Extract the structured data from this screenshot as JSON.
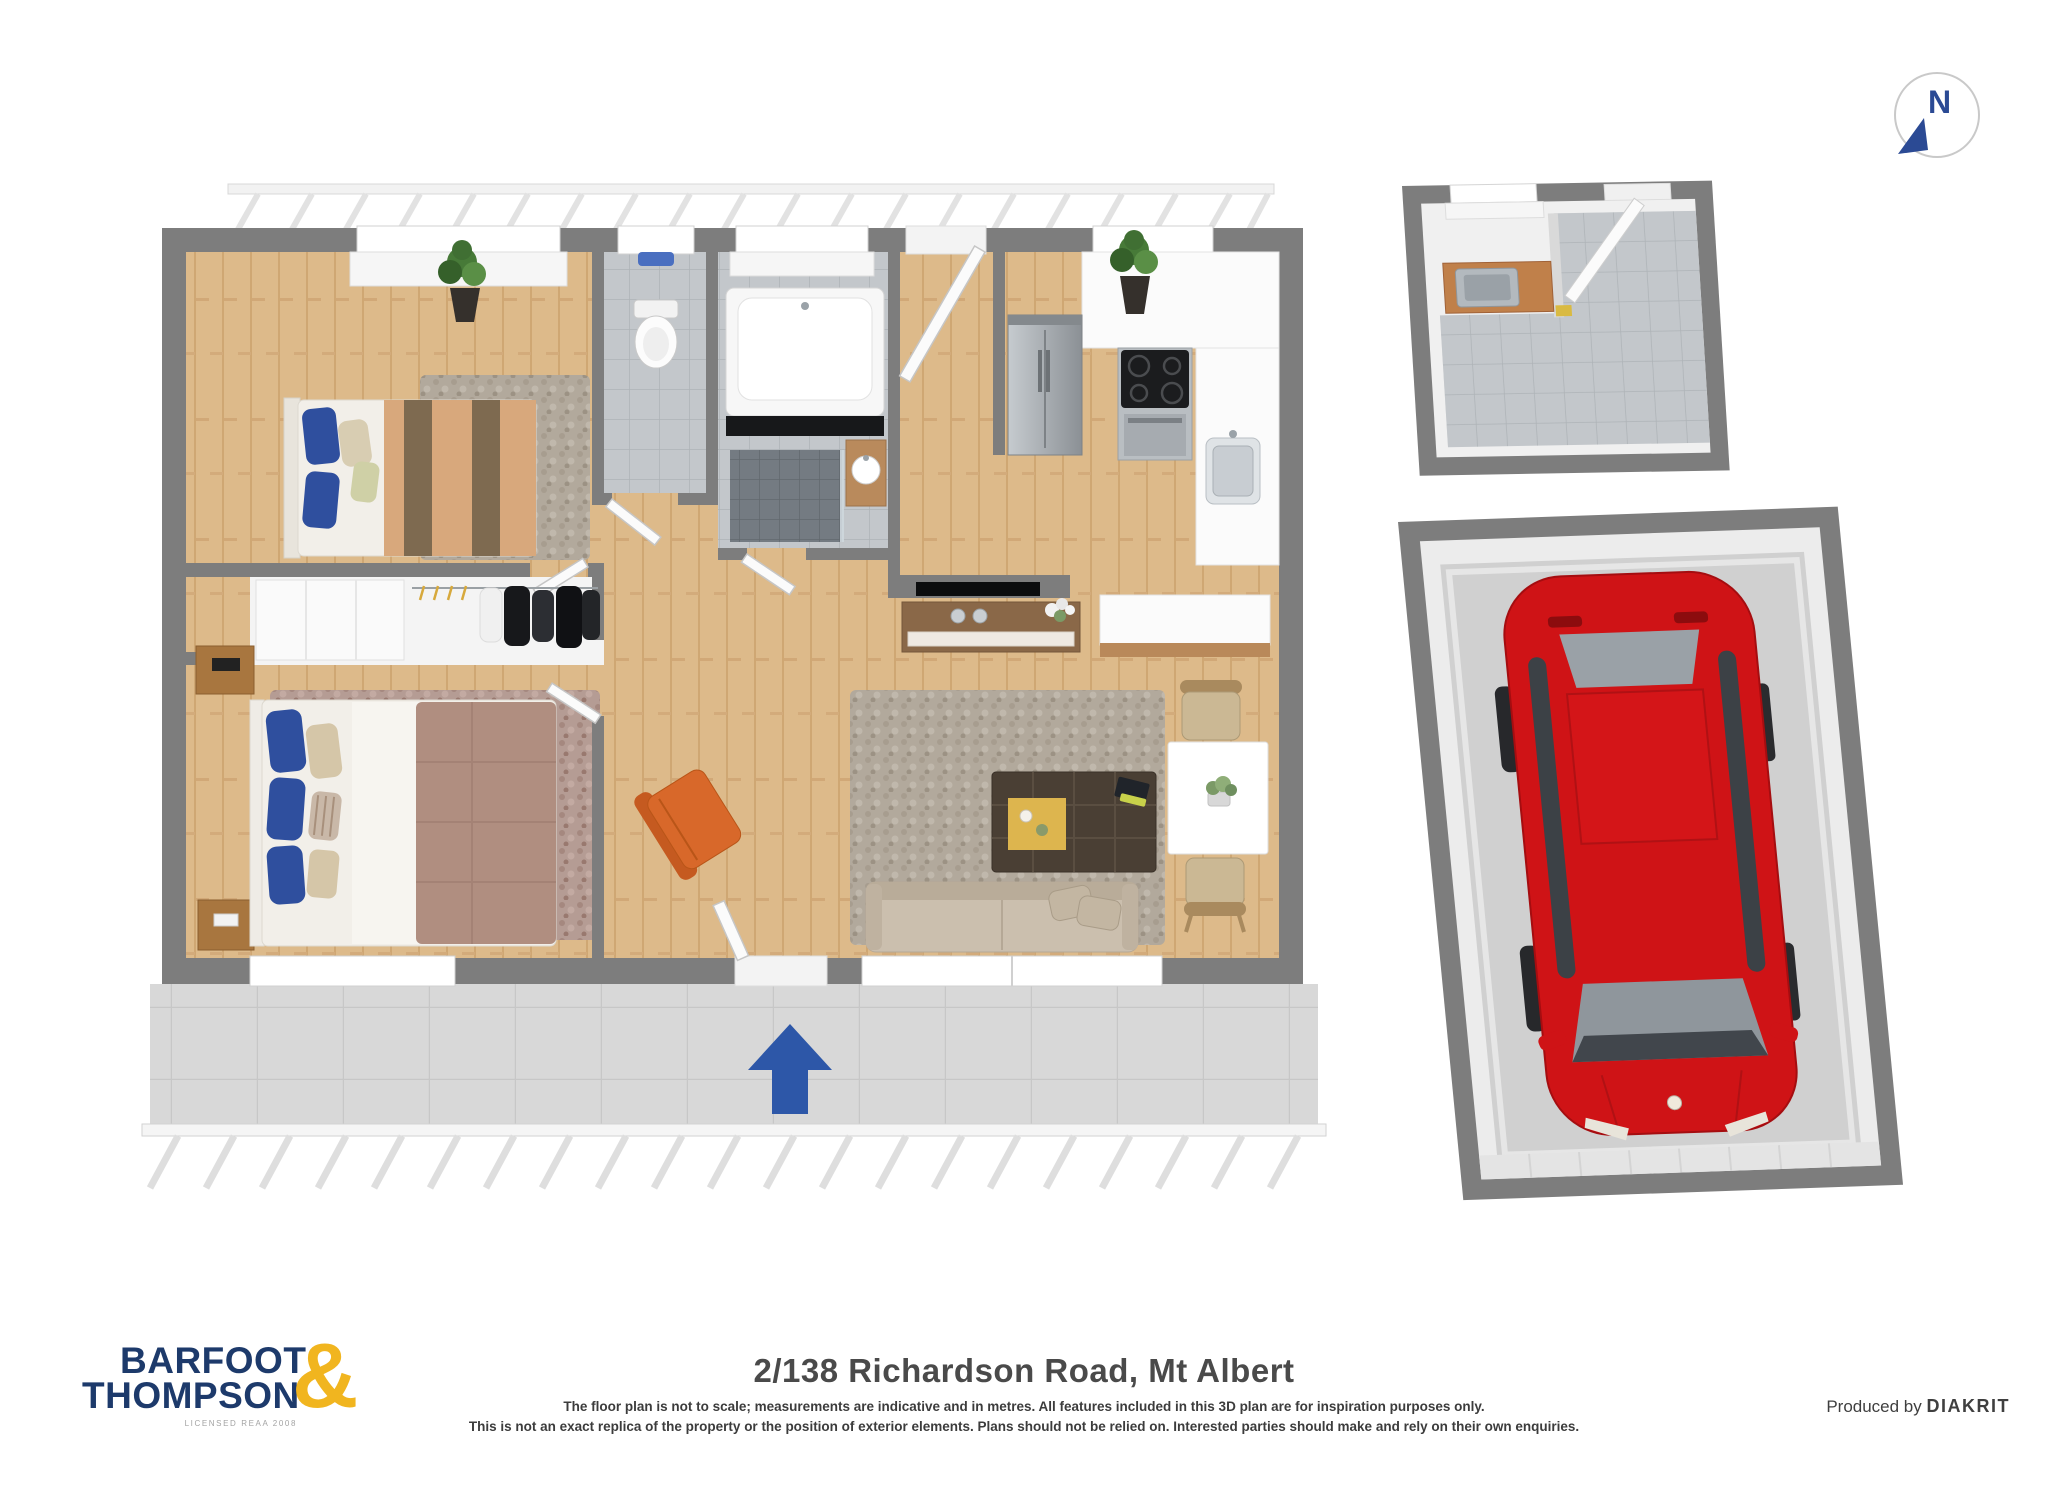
{
  "compass": {
    "label": "N"
  },
  "footer": {
    "logo": {
      "line1": "BARFOOT",
      "amp": "&",
      "line2": "THOMPSON",
      "licence": "LICENSED REAA 2008"
    },
    "address": "2/138 Richardson Road, Mt Albert",
    "disclaimer1": "The floor plan is not to scale; measurements are indicative and in metres. All features included in this 3D plan are for inspiration purposes only.",
    "disclaimer2": "This is not an exact replica of the property or the position of exterior elements. Plans should not be relied on. Interested parties should make and rely on their own enquiries.",
    "produced_by": "Produced by",
    "producer": "DIAKRIT"
  },
  "colors": {
    "accent_blue": "#2d57a8",
    "logo_navy": "#1d3a6b",
    "logo_gold": "#f1b51f",
    "wall_gray": "#7d7d7d",
    "wood_floor": "#ddba8a",
    "car_red": "#cf1316"
  }
}
